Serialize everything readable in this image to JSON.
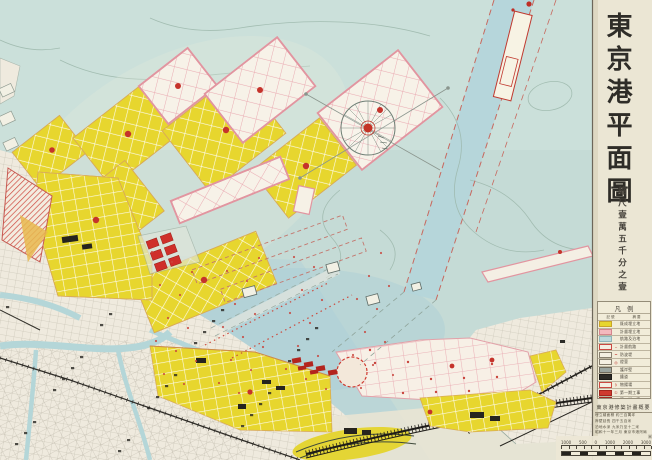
{
  "title": "東京港平面圖",
  "scale_note": "縮尺壹萬五千分之壹",
  "legend": {
    "title": "凡例",
    "header": {
      "symbol": "記號",
      "desc": "摘要"
    },
    "rows": [
      {
        "swatch": "#e7d62e",
        "border": "#c9a52a",
        "mark": "",
        "label": "既成埋立地"
      },
      {
        "swatch": "#f3b9be",
        "border": "#d4858e",
        "mark": "",
        "label": "計畫埋立地"
      },
      {
        "swatch": "#bcd9dc",
        "border": "#8fb6ba",
        "mark": "",
        "label": "航路及泊地"
      },
      {
        "swatch": "#f4efe2",
        "border": "#cc4a42",
        "mark": "╌",
        "label": "計畫航路"
      },
      {
        "swatch": "#f4efe2",
        "border": "#88806f",
        "mark": "━",
        "label": "防波堤"
      },
      {
        "swatch": "#f4efe2",
        "border": "#88806f",
        "mark": "◎",
        "label": "燈臺"
      },
      {
        "swatch": "#9aa49f",
        "border": "#6f6a5c",
        "mark": "",
        "label": "護岸壁"
      },
      {
        "swatch": "#2b2a26",
        "border": "#1d1c19",
        "mark": "",
        "label": "鐵道"
      },
      {
        "swatch": "#f4efe2",
        "border": "#cc4a42",
        "mark": "〻",
        "label": "物揚場"
      },
      {
        "swatch": "#cf3a30",
        "border": "#a3271f",
        "mark": "①",
        "label": "第一期工事"
      },
      {
        "swatch": "#cf3a30",
        "border": "#a3271f",
        "mark": "②",
        "label": "第二期工事"
      }
    ]
  },
  "info_box": {
    "title": "東京港修築計畫概要",
    "lines": [
      "埋立總面積 約三百萬坪",
      "岸壁延長 四千五百米",
      "泊地水深 九米乃至十二米",
      "昭和十一年三月 東京市港灣局"
    ]
  },
  "scale_bar": {
    "numbers": [
      "1000",
      "500",
      "0",
      "1000",
      "2000",
      "3000"
    ],
    "unit": "米",
    "segments": 10
  },
  "colors": {
    "water": "#c5dbd6",
    "deep_water": "#afd0d6",
    "reclaimed_yellow": "#e7d62e",
    "planned_pink": "#e295a0",
    "accent_red": "#c5332b",
    "city_land": "#efeade",
    "paper_margin": "#ebe6d4"
  }
}
